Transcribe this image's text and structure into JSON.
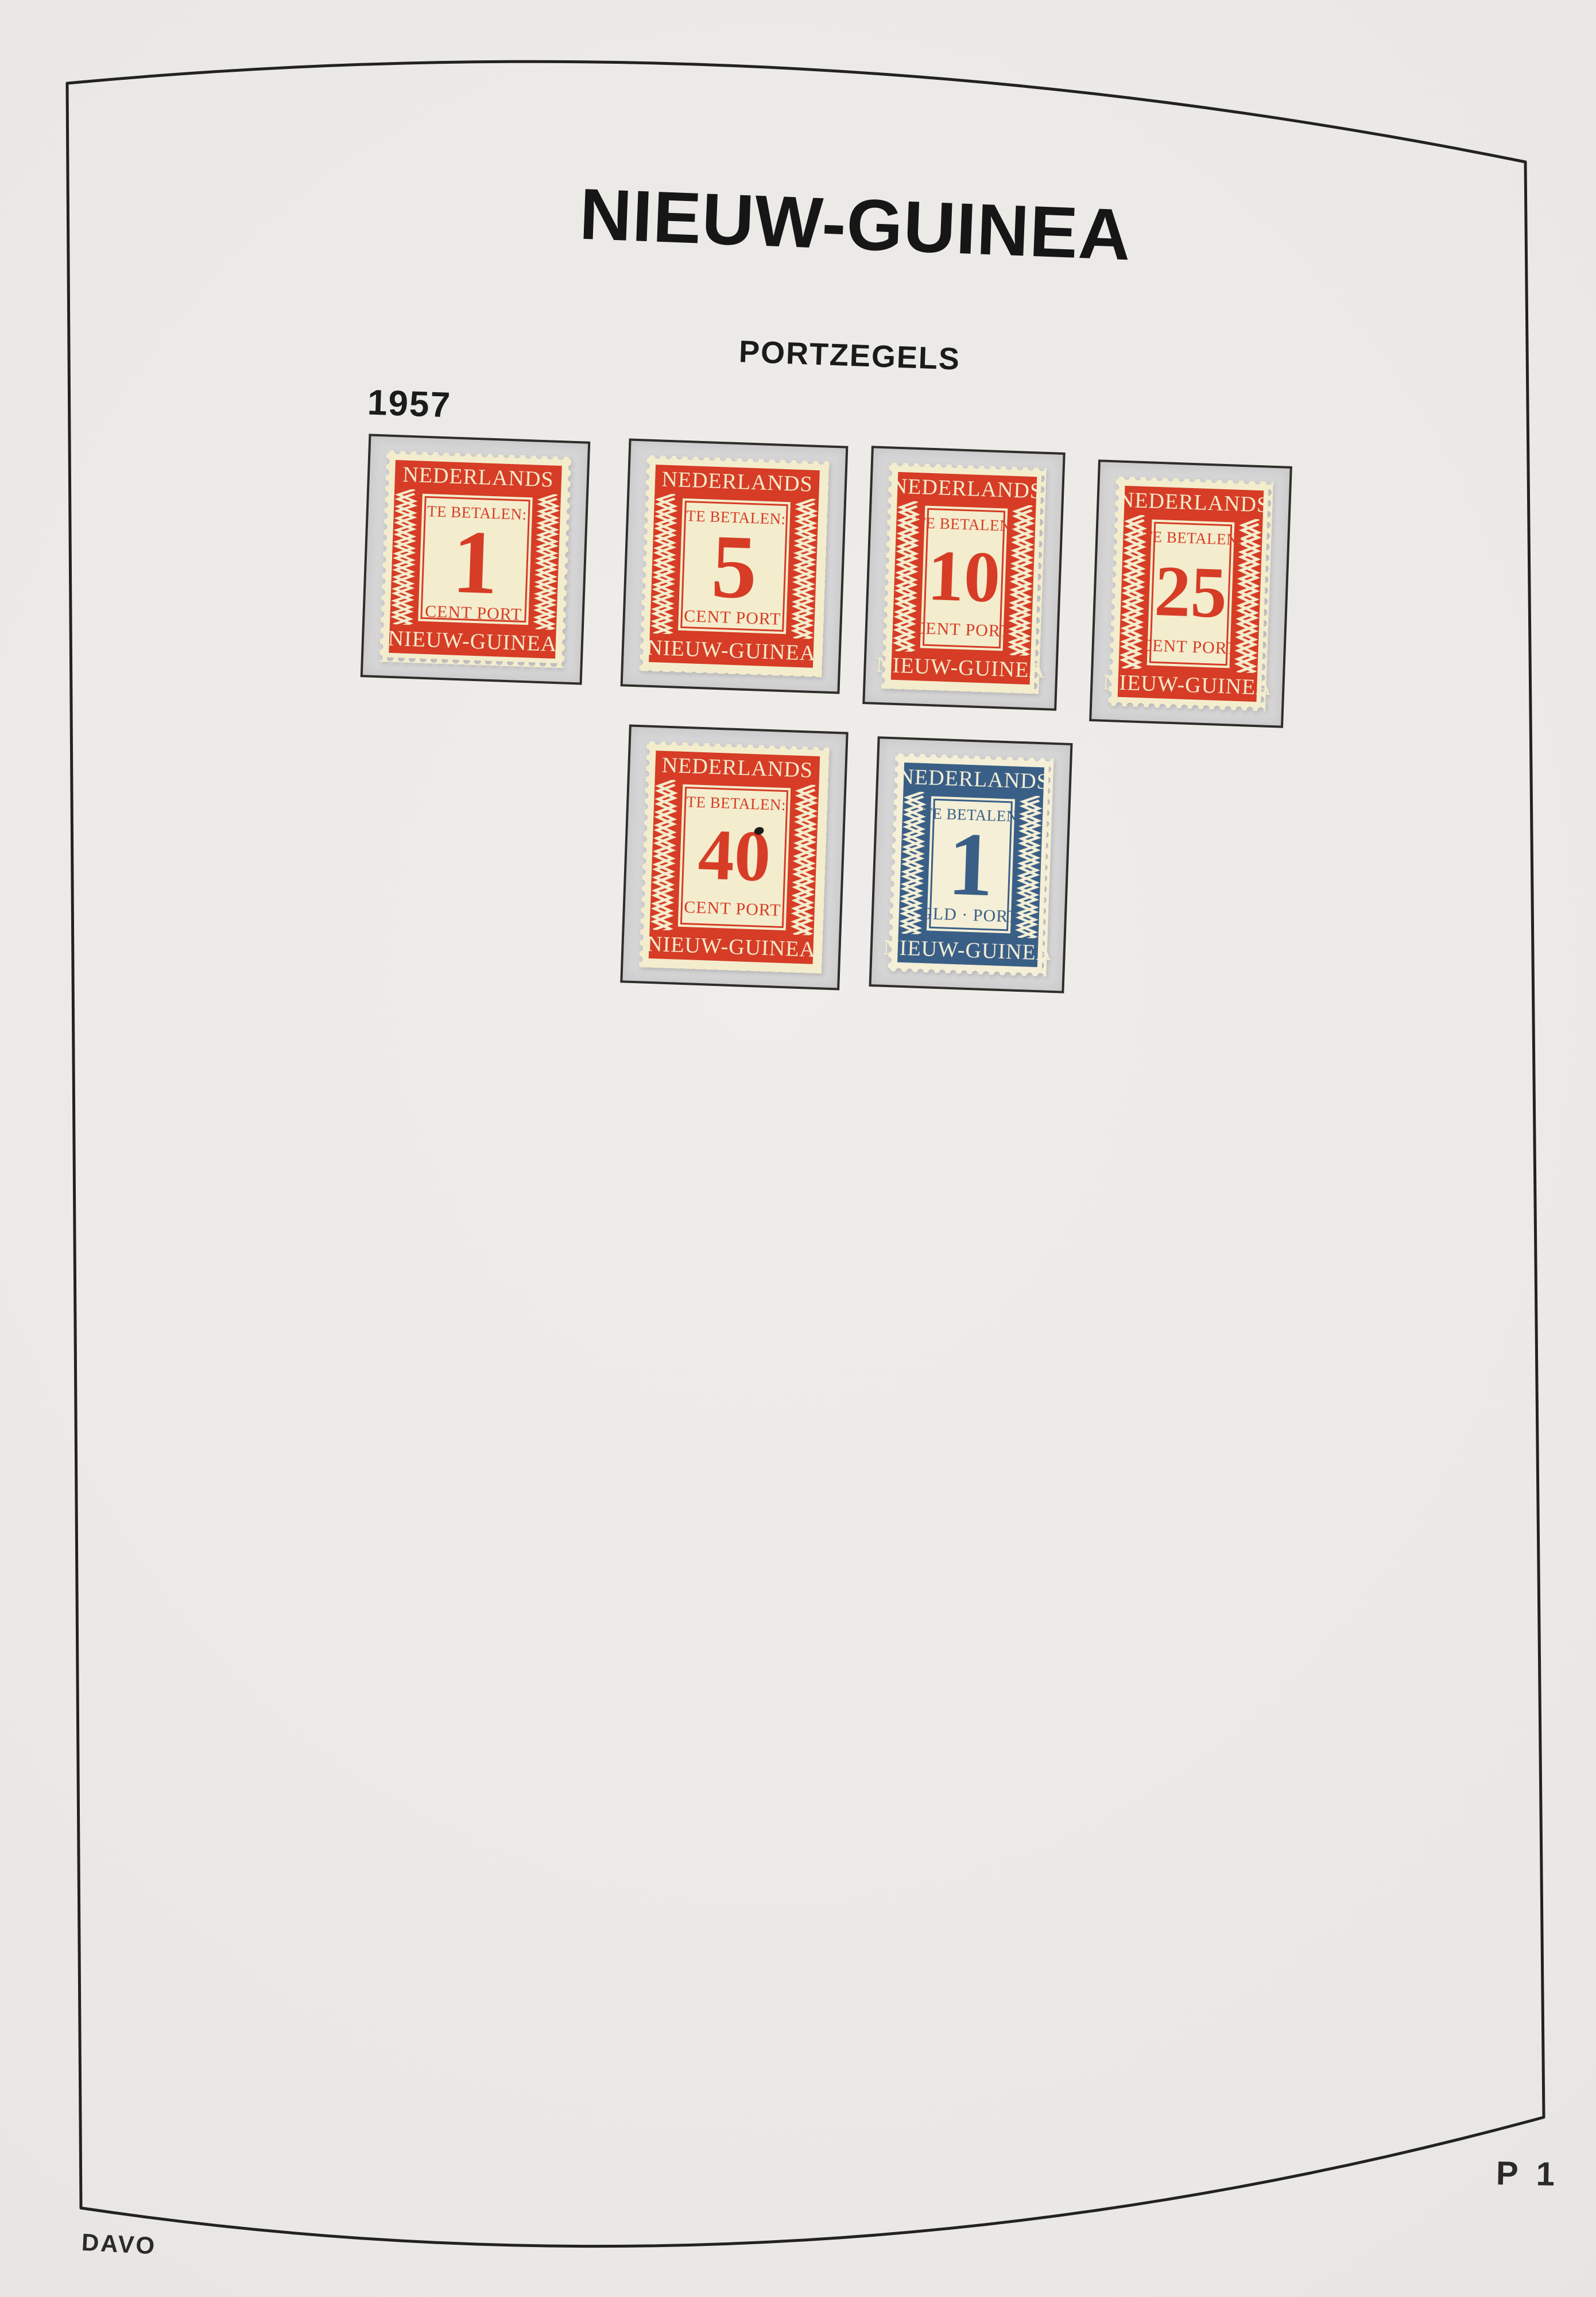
{
  "page": {
    "title": "NIEUW-GUINEA",
    "subtitle": "PORTZEGELS",
    "year": "1957",
    "page_number": "P 1",
    "publisher": "DAVO"
  },
  "colors": {
    "stamp_red": "#d63c26",
    "stamp_blue": "#3a5f87",
    "stamp_paper_cream": "#f3edcd",
    "mount_gray": "#d6d5d6",
    "page_background": "#eae8e5",
    "frame_line": "#222222"
  },
  "stamps": [
    {
      "country": "NEDERLANDS",
      "pay_label": "TE BETALEN:",
      "value": "1",
      "unit_label": "CENT PORT",
      "bottom_label": "NIEUW-GUINEA",
      "color": "red"
    },
    {
      "country": "NEDERLANDS",
      "pay_label": "TE BETALEN:",
      "value": "5",
      "unit_label": "CENT PORT",
      "bottom_label": "NIEUW-GUINEA",
      "color": "red"
    },
    {
      "country": "NEDERLANDS",
      "pay_label": "TE BETALEN:",
      "value": "10",
      "unit_label": "CENT PORT",
      "bottom_label": "NIEUW-GUINEA",
      "color": "red"
    },
    {
      "country": "NEDERLANDS",
      "pay_label": "TE BETALEN:",
      "value": "25",
      "unit_label": "CENT PORT",
      "bottom_label": "NIEUW-GUINEA",
      "color": "red"
    },
    {
      "country": "NEDERLANDS",
      "pay_label": "TE BETALEN:",
      "value": "40",
      "unit_label": "CENT PORT",
      "bottom_label": "NIEUW-GUINEA",
      "color": "red"
    },
    {
      "country": "NEDERLANDS",
      "pay_label": "TE BETALEN:",
      "value": "1",
      "unit_label": "GLD · PORT",
      "bottom_label": "NIEUW-GUINEA",
      "color": "blue"
    }
  ]
}
